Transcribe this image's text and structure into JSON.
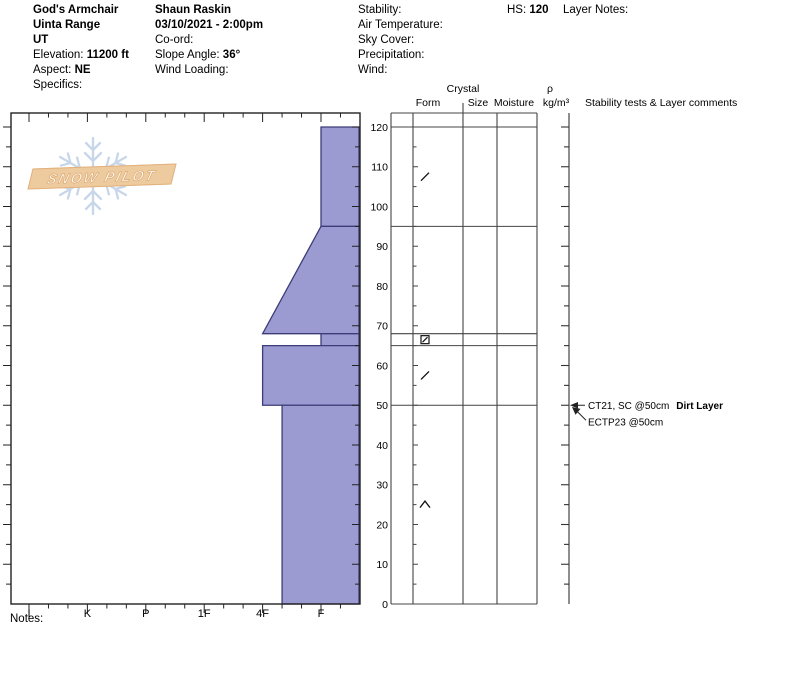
{
  "header": {
    "location": {
      "site": "God's Armchair",
      "range": "Uinta Range",
      "state": "UT",
      "elevation_label": "Elevation:",
      "elevation": "11200 ft",
      "aspect_label": "Aspect:",
      "aspect": "NE",
      "specifics_label": "Specifics:"
    },
    "observation": {
      "observer": "Shaun Raskin",
      "datetime": "03/10/2021 - 2:00pm",
      "coord_label": "Co-ord:",
      "slope_angle_label": "Slope Angle:",
      "slope_angle": "36°",
      "wind_loading_label": "Wind Loading:"
    },
    "conditions": {
      "stability_label": "Stability:",
      "air_temperature_label": "Air Temperature:",
      "sky_cover_label": "Sky Cover:",
      "precipitation_label": "Precipitation:",
      "wind_label": "Wind:"
    },
    "hs_label": "HS:",
    "hs_value": "120",
    "layer_notes_label": "Layer Notes:"
  },
  "table_headers": {
    "crystal": "Crystal",
    "form": "Form",
    "size": "Size",
    "moisture": "Moisture",
    "density_symbol": "ρ",
    "density_units": "kg/m³",
    "stability_tests": "Stability tests & Layer comments"
  },
  "logo": {
    "line": "SNOW PILOT"
  },
  "notes_label": "Notes:",
  "chart_data": {
    "type": "bar",
    "subtype": "snow-pit-hardness-profile",
    "title": "Snow profile, God's Armchair 03/10/2021",
    "xlabel": "hand hardness",
    "ylabel": "depth (cm)",
    "hardness_ticks": [
      "I",
      "K",
      "P",
      "1F",
      "4F",
      "F"
    ],
    "depth_axis": {
      "min": 0,
      "max": 120,
      "major_tick": 10,
      "minor_tick": 5,
      "unit": "cm",
      "labels": [
        "0",
        "10",
        "20",
        "30",
        "40",
        "50",
        "60",
        "70",
        "80",
        "90",
        "100",
        "110",
        "120"
      ]
    },
    "total_height_cm": 120,
    "layers": [
      {
        "top_cm": 120,
        "bottom_cm": 95,
        "hardness": "F",
        "form_symbol": "slash"
      },
      {
        "top_cm": 95,
        "bottom_cm": 68,
        "hardness_top": "F",
        "hardness_bottom": "4F"
      },
      {
        "top_cm": 68,
        "bottom_cm": 65,
        "hardness": "F",
        "form_symbol": "square-slash"
      },
      {
        "top_cm": 65,
        "bottom_cm": 50,
        "hardness": "4F",
        "form_symbol": "slash"
      },
      {
        "top_cm": 50,
        "bottom_cm": 0,
        "hardness": "4F-",
        "form_symbol": "chevron-up"
      }
    ],
    "annotations": [
      {
        "depth_cm": 50,
        "text": "CT21, SC @50cm",
        "bold_text": "Dirt Layer"
      },
      {
        "depth_cm": 50,
        "text": "ECTP23 @50cm",
        "bold_text": ""
      }
    ],
    "colors": {
      "layer_fill": "#9b9bd2",
      "layer_stroke": "#3c3c78",
      "axis": "#222222",
      "grid": "#444444"
    },
    "legend": "none",
    "grid": "off"
  }
}
